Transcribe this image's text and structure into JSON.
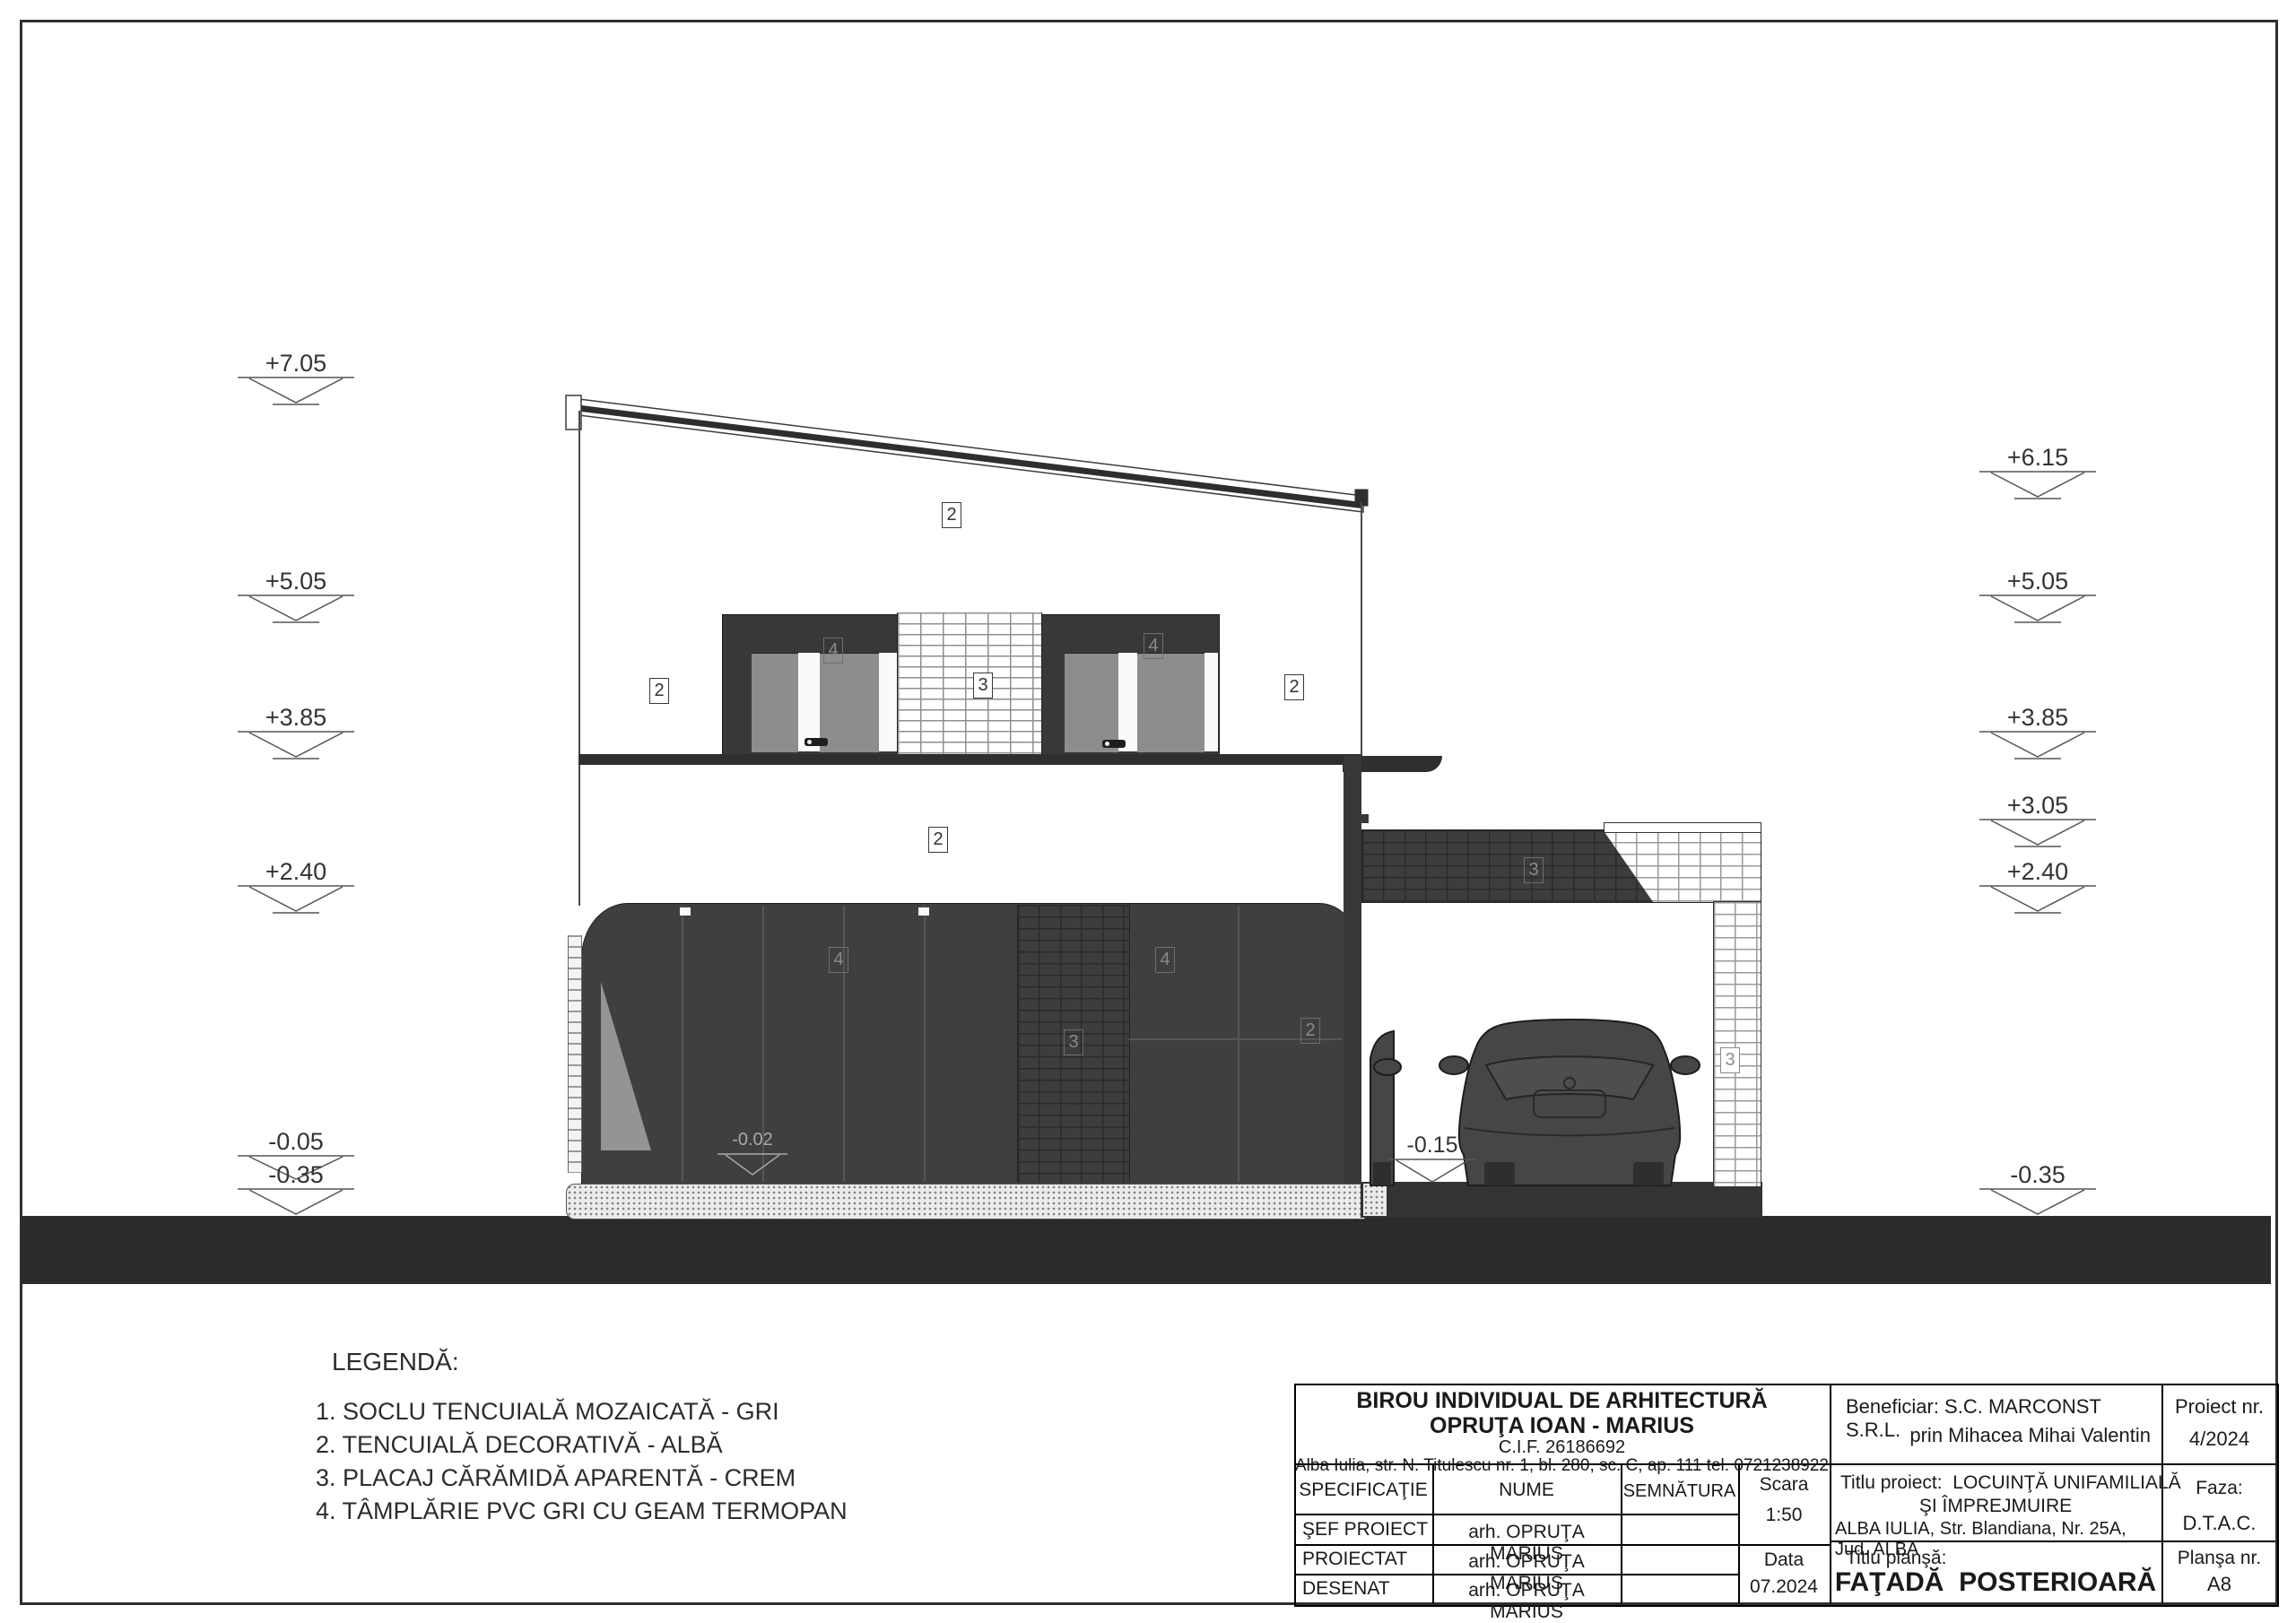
{
  "sheet": {
    "type_label": "elevation drawing",
    "colors": {
      "ink": "#1c1c1c",
      "dark_fill": "#3d3d3d",
      "ground": "#2b2b2b",
      "pane_gray": "#8d8d8d"
    }
  },
  "elevations": {
    "left": [
      "+7.05",
      "+5.05",
      "+3.85",
      "+2.40",
      "-0.05",
      "-0.35"
    ],
    "right": [
      "+6.15",
      "+5.05",
      "+3.85",
      "+3.05",
      "+2.40",
      "-0.35"
    ],
    "inline": {
      "door": "-0.02",
      "carport": "-0.15"
    }
  },
  "callouts": {
    "roof": "2",
    "wall_left": "2",
    "wall_right": "2",
    "win_up_left": "4",
    "pier_up": "3",
    "win_up_right": "4",
    "slab": "2",
    "gf_left": "4",
    "gf_pier": "3",
    "gf_right": "4",
    "gf_wall": "2",
    "parapet": "3",
    "pillar": "3"
  },
  "legend": {
    "title": "LEGENDĂ:",
    "items": [
      "1. SOCLU TENCUIALĂ MOZAICATĂ - GRI",
      "2. TENCUIALĂ DECORATIVĂ - ALBĂ",
      "3. PLACAJ CĂRĂMIDĂ APARENTĂ - CREM",
      "4. TÂMPLĂRIE PVC GRI CU GEAM TERMOPAN"
    ]
  },
  "title_block": {
    "office_line1": "BIROU INDIVIDUAL DE ARHITECTURĂ",
    "office_line2": "OPRUŢA IOAN - MARIUS",
    "office_cif": "C.I.F. 26186692",
    "office_address": "Alba Iulia, str. N. Titulescu nr. 1, bl. 280, sc. C, ap. 111 tel. 0721238922",
    "beneficiar_line1": "Beneficiar: S.C. MARCONST S.R.L.",
    "beneficiar_line2": "prin Mihacea Mihai Valentin",
    "proiect_nr_label": "Proiect nr.",
    "proiect_nr_value": "4/2024",
    "col_specificatie": "SPECIFICAŢIE",
    "col_nume": "NUME",
    "col_semnatura": "SEMNĂTURA",
    "scara_label": "Scara",
    "scara_value": "1:50",
    "titlu_proiect_line1": "Titlu proiect:  LOCUINŢĂ UNIFAMILIALĂ",
    "titlu_proiect_line2": "ŞI ÎMPREJMUIRE",
    "titlu_proiect_line3": "ALBA IULIA, Str. Blandiana, Nr. 25A, Jud. ALBA",
    "faza_label": "Faza:",
    "faza_value": "D.T.A.C.",
    "rows": [
      {
        "spec": "ŞEF PROIECT",
        "nume": "arh. OPRUŢA MARIUS",
        "semnatura": ""
      },
      {
        "spec": "PROIECTAT",
        "nume": "arh. OPRUŢA MARIUS",
        "semnatura": ""
      },
      {
        "spec": "DESENAT",
        "nume": "arh. OPRUŢA MARIUS",
        "semnatura": ""
      }
    ],
    "data_label": "Data",
    "data_value": "07.2024",
    "titlu_plansa_label": "Titlu planşă:",
    "titlu_plansa_value": "FAŢADĂ  POSTERIOARĂ",
    "plansa_label": "Planşa nr.",
    "plansa_value": "A8"
  }
}
